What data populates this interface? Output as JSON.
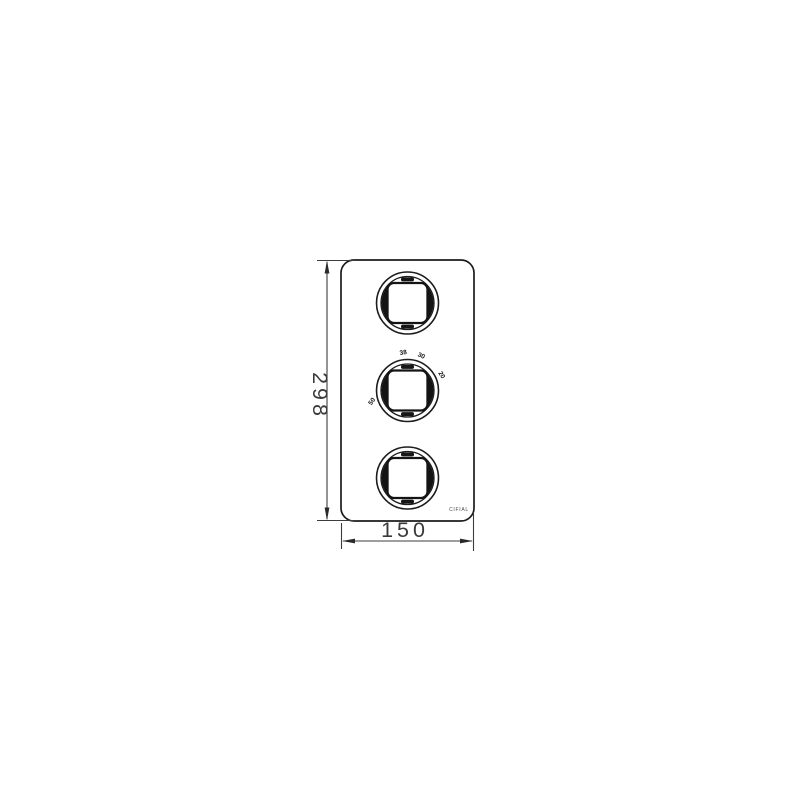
{
  "drawing": {
    "dimension_height": "298",
    "dimension_width": "150",
    "brand": "CIFIAL",
    "temperature_marks": [
      {
        "value": "38"
      },
      {
        "value": "30"
      },
      {
        "value": "20"
      },
      {
        "value": "50"
      }
    ],
    "colors": {
      "plate_line": "#1c1c1c",
      "dimension_line": "#3c3c3c",
      "dimension_text": "#3a3a3a",
      "mark_fill": "#151515",
      "background": "#ffffff"
    }
  }
}
